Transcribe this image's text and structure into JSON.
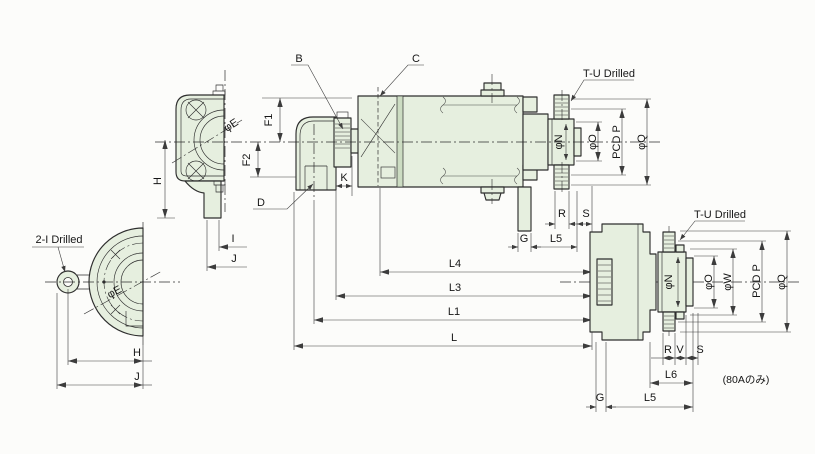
{
  "drawing_type": "technical-dimension-drawing",
  "labels": {
    "b": "B",
    "c": "C",
    "d": "D",
    "k": "K",
    "f1": "F1",
    "f2": "F2",
    "h": "H",
    "i": "I",
    "j": "J",
    "g": "G",
    "r": "R",
    "s": "S",
    "v": "V",
    "l": "L",
    "l1": "L1",
    "l3": "L3",
    "l4": "L4",
    "l5": "L5",
    "l6": "L6",
    "phi_e": "φE",
    "phi_n": "φN",
    "phi_o": "φO",
    "phi_q": "φQ",
    "phi_w": "φW",
    "pcd_p": "PCD P",
    "t_u_drilled": "T-U Drilled",
    "two_i_drilled": "2-I Drilled",
    "note_80a": "(80Aのみ)"
  },
  "colors": {
    "part_fill": "#e6efdf",
    "part_fill_dark": "#ccdcc2",
    "line": "#2e2e2e",
    "dim": "#3c3c3c",
    "background": "#fcfcfa"
  }
}
